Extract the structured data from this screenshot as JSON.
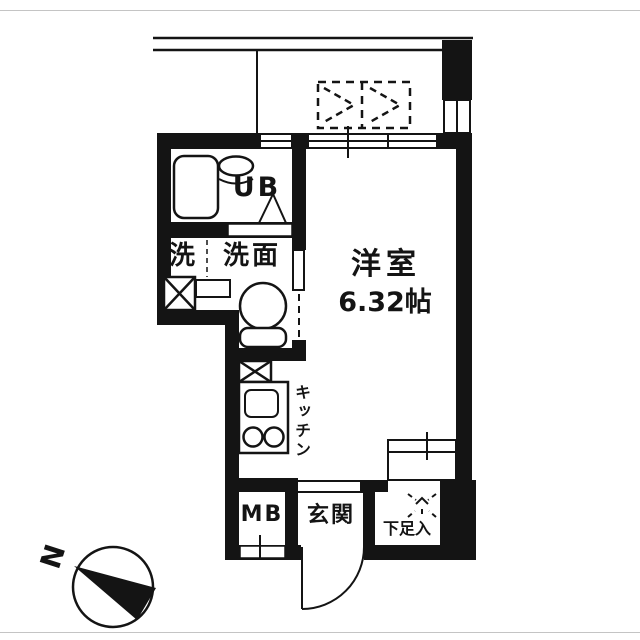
{
  "floorplan": {
    "labels": {
      "unit_bath": "UB",
      "laundry": "洗",
      "washroom": "洗面",
      "kitchen": "キッチン",
      "meter_box": "MB",
      "entrance": "玄関",
      "shoe_cabinet": "下足入",
      "room_name": "洋室",
      "room_size": "6.32帖"
    },
    "compass": {
      "label": "N"
    },
    "colors": {
      "wall": "#141414",
      "floor": "#ffffff",
      "frame": "#c4c4c4"
    }
  }
}
